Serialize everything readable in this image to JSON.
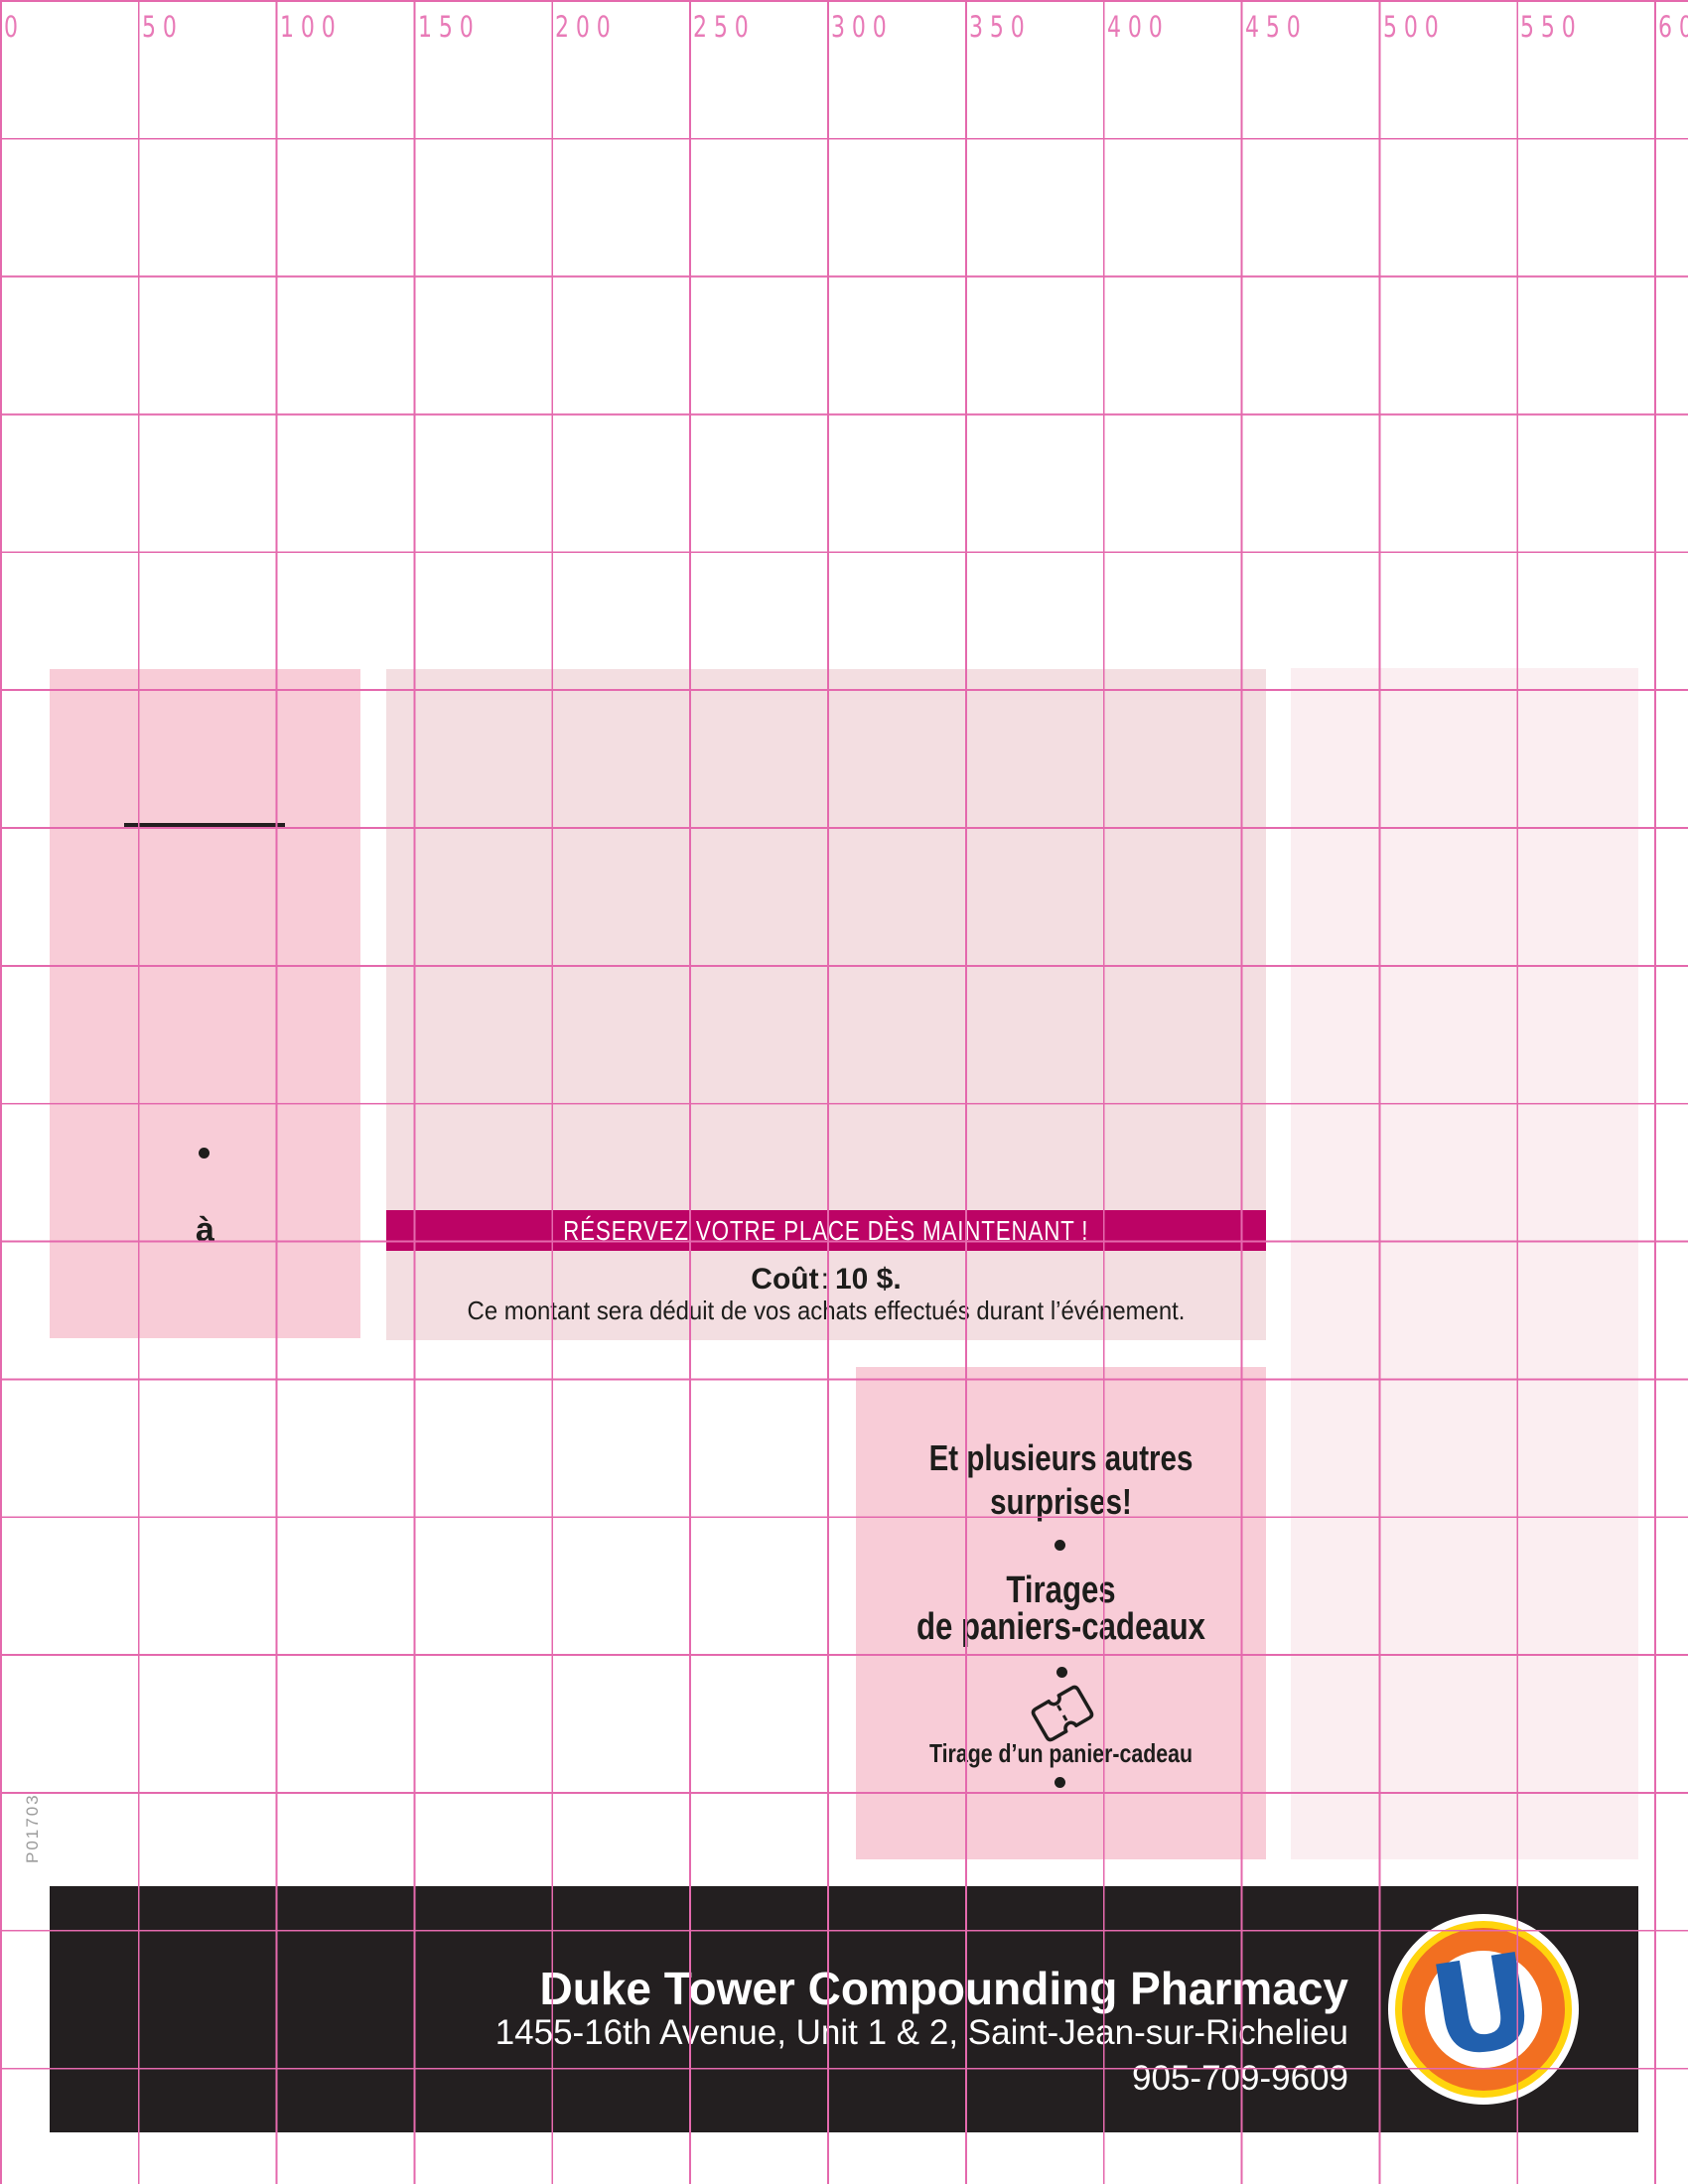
{
  "ruler": {
    "labels": [
      "0",
      "50",
      "100",
      "150",
      "200",
      "250",
      "300",
      "350",
      "400",
      "450",
      "500",
      "550",
      "600"
    ]
  },
  "code_label": "P01703",
  "left_block": {
    "to_label": "à"
  },
  "banner": {
    "text": "RÉSERVEZ VOTRE PLACE DÈS MAINTENANT !"
  },
  "cost": {
    "label": "Coût",
    "colon": ":",
    "value": "10 $.",
    "note": "Ce montant sera déduit de vos achats effectués durant l’événement."
  },
  "prizes": {
    "line1": "Et plusieurs autres",
    "line2": "surprises!",
    "line3": "Tirages",
    "line4": "de paniers-cadeaux",
    "ticket_caption": "Tirage d’un panier-cadeau"
  },
  "footer": {
    "name": "Duke Tower Compounding Pharmacy",
    "address": "1455-16th Avenue, Unit 1 & 2, Saint-Jean-sur-Richelieu",
    "phone": "905-709-9609",
    "logo_letter": "U"
  },
  "colors": {
    "grid_pink": "#e469ad",
    "ruler_text_pink": "#e87ab7",
    "block_pink": "#f8ccd7",
    "block_pale": "#f3dee1",
    "block_faint": "#fbeef1",
    "banner_magenta": "#bc0365",
    "footer_black": "#231f20",
    "logo_orange": "#f26f21",
    "logo_yellow": "#ffd40d",
    "logo_blue": "#2160ae"
  }
}
